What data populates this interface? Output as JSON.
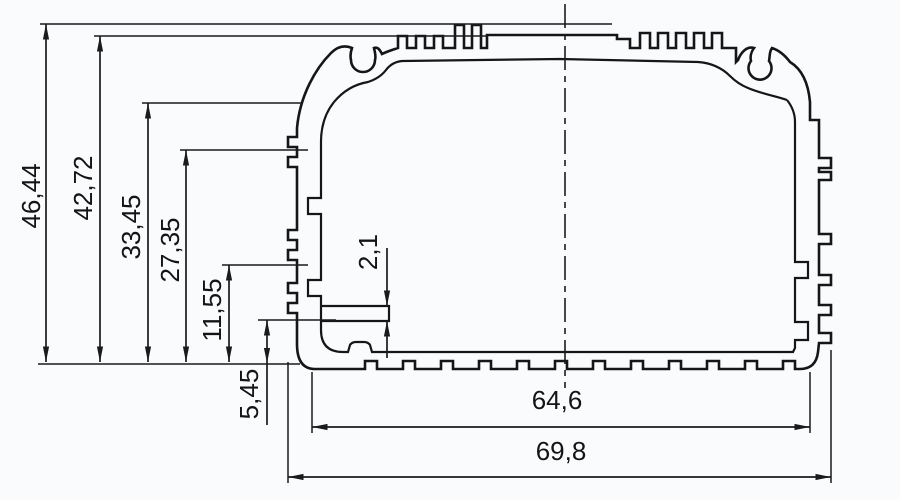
{
  "drawing": {
    "kind": "technical-cross-section",
    "dimensions": {
      "overall_height": "46,44",
      "body_height": "42,72",
      "upper_step_height": "33,45",
      "mid_step_height": "27,35",
      "slot_height": "11,55",
      "ledge_height": "5,45",
      "ledge_thickness": "2,1",
      "inner_width": "64,6",
      "overall_width": "69,8"
    },
    "colors": {
      "line": "#161616",
      "background": "#fafbfd"
    }
  }
}
